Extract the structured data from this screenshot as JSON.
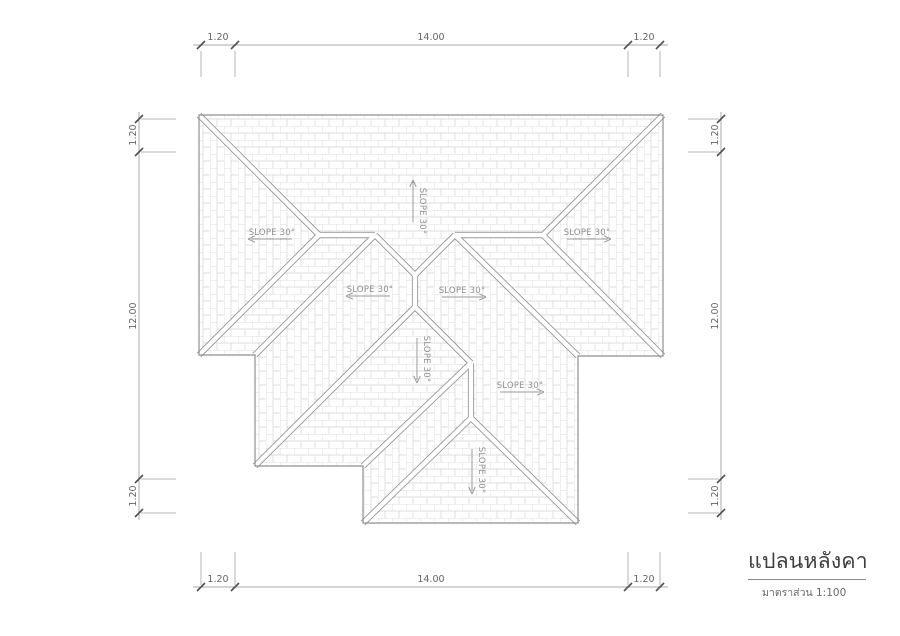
{
  "page": {
    "background": "#ffffff"
  },
  "title_block": {
    "title": "แปลนหลังคา",
    "subtitle": "มาตราส่วน 1:100"
  },
  "drawing": {
    "colors": {
      "hatch": "#d4d4d4",
      "band": "#979797",
      "core": "#ffffff",
      "outline": "#8f8f8f",
      "dim_line": "#a8a8a8",
      "witness": "#b5b5b5",
      "tick": "#4f4f4f",
      "dim_text": "#666666",
      "slope_text": "#8f8f8f",
      "slope_arrow": "#9a9a9a"
    },
    "outline": [
      [
        199,
        115
      ],
      [
        663,
        115
      ],
      [
        663,
        356
      ],
      [
        578,
        356
      ],
      [
        578,
        523
      ],
      [
        363,
        523
      ],
      [
        363,
        466
      ],
      [
        255,
        466
      ],
      [
        255,
        355
      ],
      [
        199,
        355
      ]
    ],
    "faces": [
      {
        "name": "north-face",
        "hatch": "h",
        "pts": [
          [
            199,
            115
          ],
          [
            663,
            115
          ],
          [
            543,
            235
          ],
          [
            455,
            235
          ],
          [
            415,
            275
          ],
          [
            375,
            235
          ],
          [
            319,
            235
          ]
        ]
      },
      {
        "name": "west-face",
        "hatch": "v",
        "pts": [
          [
            199,
            115
          ],
          [
            319,
            235
          ],
          [
            199,
            355
          ]
        ]
      },
      {
        "name": "east-face",
        "hatch": "v",
        "pts": [
          [
            663,
            115
          ],
          [
            663,
            356
          ],
          [
            543,
            235
          ]
        ]
      },
      {
        "name": "south-west-face",
        "hatch": "h",
        "pts": [
          [
            199,
            355
          ],
          [
            319,
            235
          ],
          [
            375,
            235
          ],
          [
            255,
            355
          ]
        ]
      },
      {
        "name": "south-east-face",
        "hatch": "h",
        "pts": [
          [
            455,
            235
          ],
          [
            543,
            235
          ],
          [
            663,
            356
          ],
          [
            578,
            356
          ]
        ]
      },
      {
        "name": "wing-west-face",
        "hatch": "v",
        "pts": [
          [
            375,
            235
          ],
          [
            415,
            275
          ],
          [
            415,
            307
          ],
          [
            255,
            466
          ],
          [
            255,
            355
          ]
        ]
      },
      {
        "name": "wing-south-face",
        "hatch": "h",
        "pts": [
          [
            415,
            307
          ],
          [
            471,
            363
          ],
          [
            363,
            466
          ],
          [
            255,
            466
          ]
        ]
      },
      {
        "name": "lower-west-face",
        "hatch": "v",
        "pts": [
          [
            471,
            363
          ],
          [
            471,
            418
          ],
          [
            363,
            523
          ],
          [
            363,
            466
          ]
        ]
      },
      {
        "name": "lower-south-face",
        "hatch": "h",
        "pts": [
          [
            471,
            418
          ],
          [
            578,
            523
          ],
          [
            363,
            523
          ]
        ]
      },
      {
        "name": "east-wing-face",
        "hatch": "v",
        "pts": [
          [
            455,
            235
          ],
          [
            578,
            356
          ],
          [
            578,
            523
          ],
          [
            471,
            418
          ],
          [
            471,
            363
          ],
          [
            415,
            307
          ],
          [
            415,
            275
          ]
        ]
      }
    ],
    "double_lines": [
      [
        199,
        115,
        319,
        235
      ],
      [
        199,
        355,
        319,
        235
      ],
      [
        319,
        235,
        375,
        235
      ],
      [
        663,
        115,
        543,
        235
      ],
      [
        663,
        356,
        543,
        235
      ],
      [
        455,
        235,
        543,
        235
      ],
      [
        375,
        235,
        415,
        275
      ],
      [
        455,
        235,
        415,
        275
      ],
      [
        415,
        275,
        415,
        307
      ],
      [
        375,
        235,
        255,
        355
      ],
      [
        455,
        235,
        578,
        356
      ],
      [
        415,
        307,
        255,
        466
      ],
      [
        415,
        307,
        471,
        363
      ],
      [
        471,
        363,
        471,
        418
      ],
      [
        471,
        418,
        363,
        523
      ],
      [
        471,
        418,
        578,
        523
      ],
      [
        471,
        363,
        363,
        466
      ]
    ],
    "slope_labels": [
      {
        "text": "SLOPE 30°",
        "dir": "up",
        "shaft": [
          413,
          222,
          413,
          181
        ],
        "tip": [
          413,
          180
        ],
        "text_pos": [
          420,
          211
        ],
        "rotated": true
      },
      {
        "text": "SLOPE 30°",
        "dir": "left",
        "shaft": [
          251,
          239,
          292,
          239
        ],
        "tip": [
          248,
          239
        ],
        "text_pos": [
          272,
          235
        ],
        "rotated": false
      },
      {
        "text": "SLOPE 30°",
        "dir": "right",
        "shaft": [
          567,
          239,
          608,
          239
        ],
        "tip": [
          611,
          239
        ],
        "text_pos": [
          587,
          235
        ],
        "rotated": false
      },
      {
        "text": "SLOPE 30°",
        "dir": "left",
        "shaft": [
          349,
          296,
          390,
          296
        ],
        "tip": [
          346,
          296
        ],
        "text_pos": [
          370,
          292
        ],
        "rotated": false
      },
      {
        "text": "SLOPE 30°",
        "dir": "right",
        "shaft": [
          442,
          297,
          483,
          297
        ],
        "tip": [
          486,
          297
        ],
        "text_pos": [
          462,
          293
        ],
        "rotated": false
      },
      {
        "text": "SLOPE 30°",
        "dir": "down",
        "shaft": [
          417,
          338,
          417,
          380
        ],
        "tip": [
          417,
          383
        ],
        "text_pos": [
          424,
          359
        ],
        "rotated": true
      },
      {
        "text": "SLOPE 30°",
        "dir": "right",
        "shaft": [
          500,
          392,
          541,
          392
        ],
        "tip": [
          544,
          392
        ],
        "text_pos": [
          520,
          388
        ],
        "rotated": false
      },
      {
        "text": "SLOPE 30°",
        "dir": "down",
        "shaft": [
          472,
          449,
          472,
          491
        ],
        "tip": [
          472,
          494
        ],
        "text_pos": [
          479,
          470
        ],
        "rotated": true
      }
    ],
    "dimensions": {
      "top": {
        "axis": "h",
        "line": 45,
        "from": 193,
        "to": 668,
        "ticks": [
          201,
          235,
          628,
          660
        ],
        "witness": [
          51,
          77
        ],
        "labels": [
          {
            "text": "1.20",
            "pos": 218
          },
          {
            "text": "14.00",
            "pos": 431
          },
          {
            "text": "1.20",
            "pos": 644
          }
        ],
        "label_off": 40
      },
      "bottom": {
        "axis": "h",
        "line": 587,
        "from": 193,
        "to": 668,
        "ticks": [
          201,
          235,
          628,
          660
        ],
        "witness": [
          552,
          585
        ],
        "labels": [
          {
            "text": "1.20",
            "pos": 218
          },
          {
            "text": "14.00",
            "pos": 431
          },
          {
            "text": "1.20",
            "pos": 644
          }
        ],
        "label_off": 582
      },
      "left": {
        "axis": "v",
        "line": 139,
        "from": 112,
        "to": 520,
        "ticks": [
          119,
          152,
          479,
          513
        ],
        "witness": [
          141,
          176
        ],
        "labels": [
          {
            "text": "1.20",
            "pos": 135
          },
          {
            "text": "12.00",
            "pos": 316
          },
          {
            "text": "1.20",
            "pos": 496
          }
        ],
        "label_off": 136
      },
      "right": {
        "axis": "v",
        "line": 721,
        "from": 112,
        "to": 520,
        "ticks": [
          119,
          152,
          479,
          513
        ],
        "witness": [
          688,
          719
        ],
        "labels": [
          {
            "text": "1.20",
            "pos": 135
          },
          {
            "text": "12.00",
            "pos": 316
          },
          {
            "text": "1.20",
            "pos": 496
          }
        ],
        "label_off": 718
      }
    }
  }
}
